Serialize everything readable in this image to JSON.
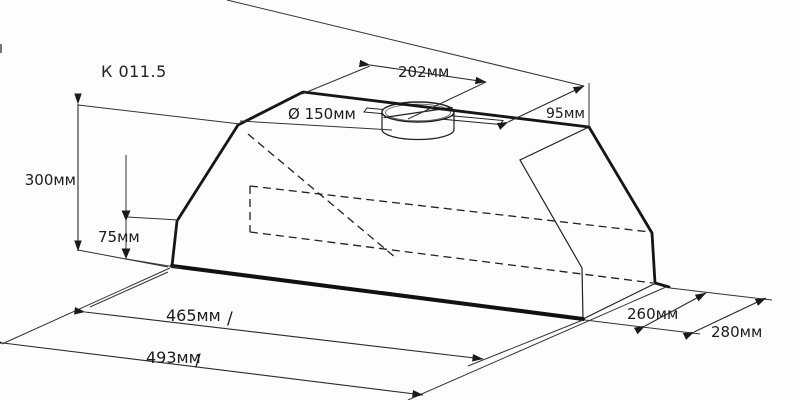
{
  "title": "К 011.5",
  "colors": {
    "line": "#1b1b1b",
    "background": "#fdfdfd"
  },
  "dimensions": {
    "duct_diameter": "Ø 150мм",
    "duct_offset": "202мм",
    "rear_offset": "95мм",
    "total_height": "300мм",
    "body_height": "75мм",
    "inner_width": "465мм",
    "inner_width_slash": "/",
    "outer_width": "493мм",
    "outer_width_slash": "/",
    "inner_depth": "260мм",
    "outer_depth": "280мм"
  }
}
